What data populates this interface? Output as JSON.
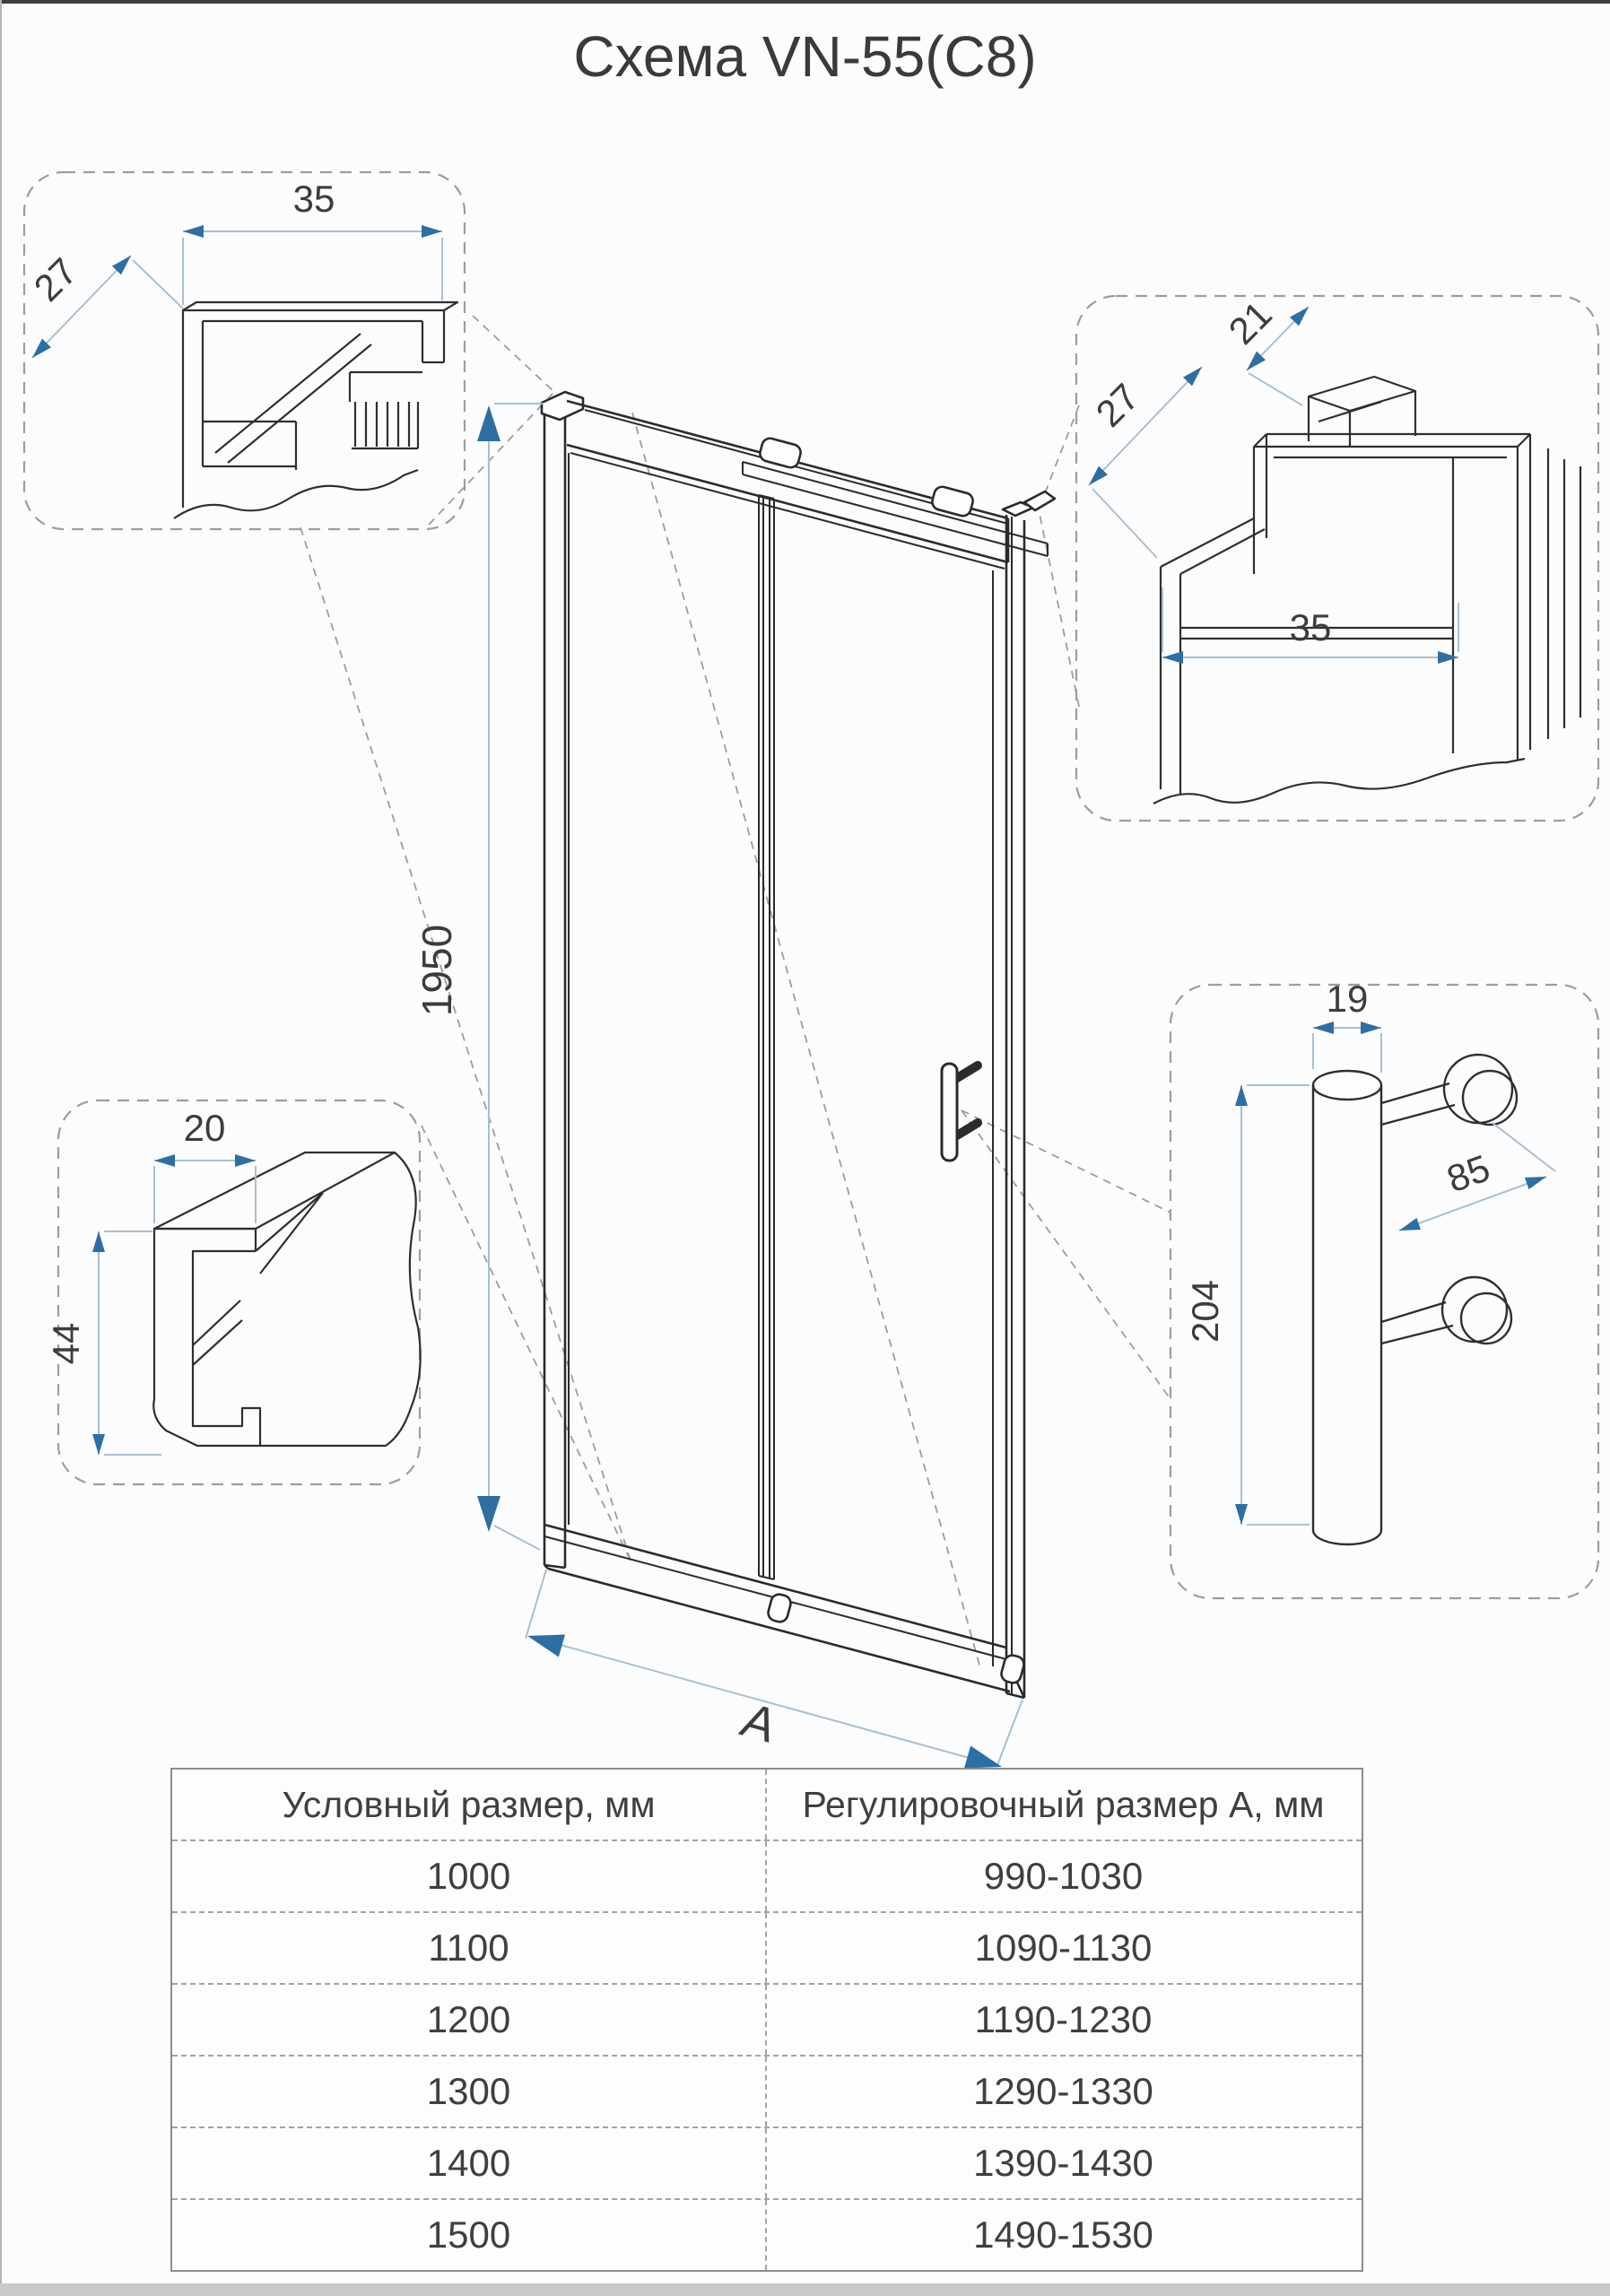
{
  "title": "Схема VN-55(C8)",
  "dims": {
    "height": "1950",
    "width": "А",
    "tl": {
      "w": "35",
      "d": "27"
    },
    "tr": {
      "d": "27",
      "t": "21",
      "w": "35"
    },
    "bl": {
      "w": "20",
      "h": "44"
    },
    "handle": {
      "dia": "19",
      "len": "204",
      "gap": "85"
    }
  },
  "table": {
    "headers": [
      "Условный размер, мм",
      "Регулировочный размер А, мм"
    ],
    "rows": [
      [
        "1000",
        "990-1030"
      ],
      [
        "1100",
        "1090-1130"
      ],
      [
        "1200",
        "1190-1230"
      ],
      [
        "1300",
        "1290-1330"
      ],
      [
        "1400",
        "1390-1430"
      ],
      [
        "1500",
        "1490-1530"
      ]
    ]
  },
  "colors": {
    "accent": "#2e6fa3",
    "line": "#2b2b2b",
    "dim_line": "#a7c0d2",
    "dashed": "#9d9d9d"
  }
}
